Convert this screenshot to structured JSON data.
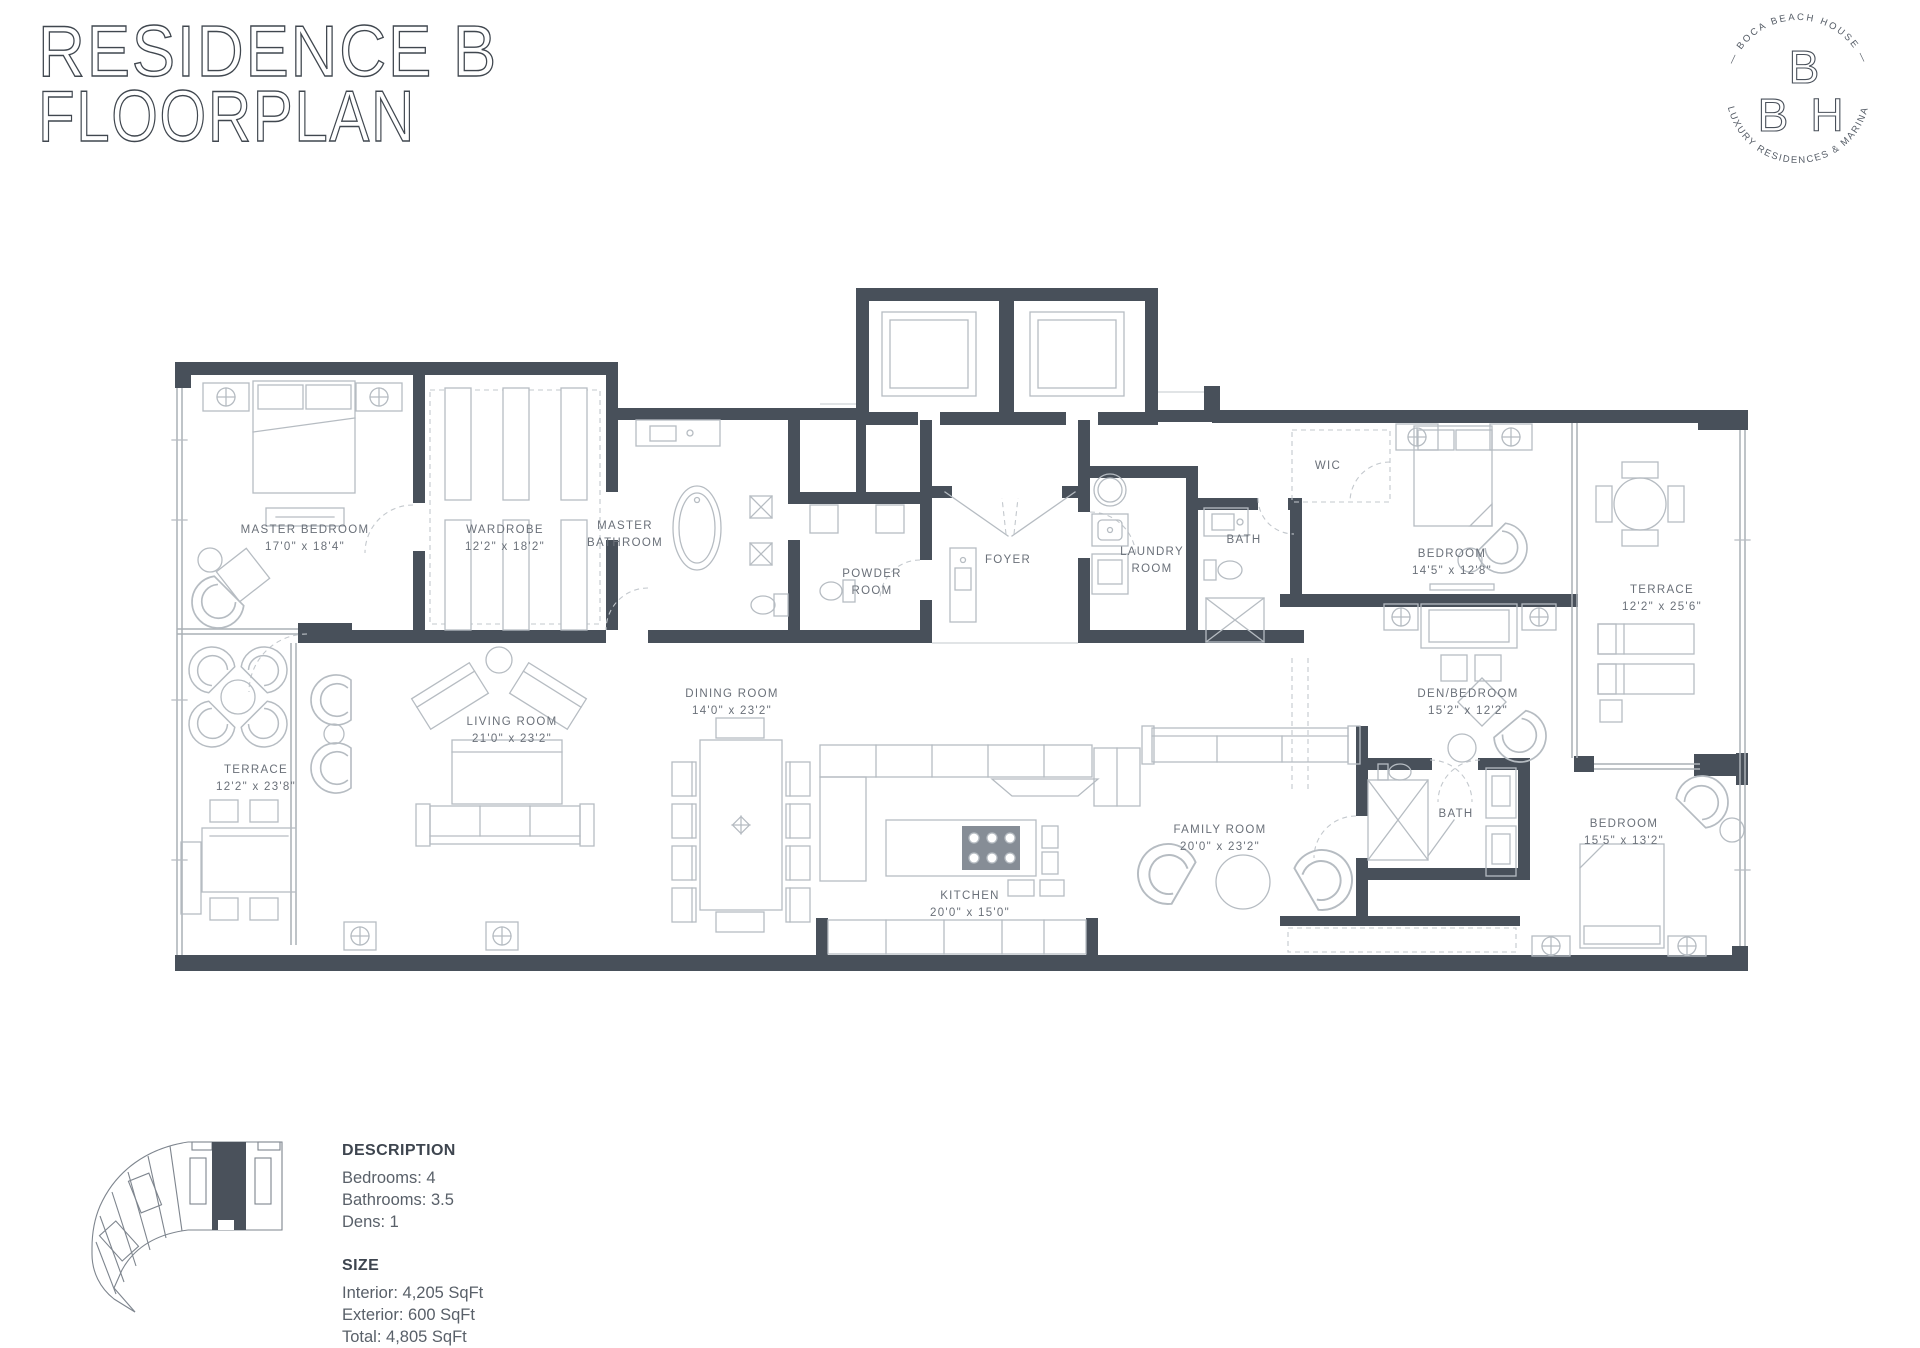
{
  "header": {
    "title_line1": "RESIDENCE B",
    "title_line2": "FLOORPLAN"
  },
  "logo": {
    "arc_top": "— BOCA BEACH HOUSE —",
    "arc_bottom": "LUXURY RESIDENCES & MARINA",
    "monogram_top": "B",
    "monogram_left": "B",
    "monogram_right": "H"
  },
  "rooms": [
    {
      "id": "master-bedroom",
      "line1": "MASTER BEDROOM",
      "line2": "17'0\" x 18'4\""
    },
    {
      "id": "wardrobe",
      "line1": "WARDROBE",
      "line2": "12'2\" x 18'2\""
    },
    {
      "id": "master-bathroom",
      "line1": "MASTER",
      "line2": "BATHROOM"
    },
    {
      "id": "powder-room",
      "line1": "POWDER",
      "line2": "ROOM"
    },
    {
      "id": "foyer",
      "line1": "FOYER",
      "line2": ""
    },
    {
      "id": "laundry-room",
      "line1": "LAUNDRY",
      "line2": "ROOM"
    },
    {
      "id": "bath-center",
      "line1": "BATH",
      "line2": ""
    },
    {
      "id": "wic",
      "line1": "WIC",
      "line2": ""
    },
    {
      "id": "bedroom-upper",
      "line1": "BEDROOM",
      "line2": "14'5\" x 12'8\""
    },
    {
      "id": "terrace-right",
      "line1": "TERRACE",
      "line2": "12'2\" x 25'6\""
    },
    {
      "id": "den-bedroom",
      "line1": "DEN/BEDROOM",
      "line2": "15'2\" x 12'2\""
    },
    {
      "id": "living-room",
      "line1": "LIVING ROOM",
      "line2": "21'0\" x 23'2\""
    },
    {
      "id": "dining-room",
      "line1": "DINING ROOM",
      "line2": "14'0\" x 23'2\""
    },
    {
      "id": "terrace-left",
      "line1": "TERRACE",
      "line2": "12'2\" x 23'8\""
    },
    {
      "id": "kitchen",
      "line1": "KITCHEN",
      "line2": "20'0\" x 15'0\""
    },
    {
      "id": "family-room",
      "line1": "FAMILY ROOM",
      "line2": "20'0\" x 23'2\""
    },
    {
      "id": "bath-lower",
      "line1": "BATH",
      "line2": ""
    },
    {
      "id": "bedroom-lower",
      "line1": "BEDROOM",
      "line2": "15'5\" x 13'2\""
    }
  ],
  "details": {
    "description_title": "DESCRIPTION",
    "description_items": [
      "Bedrooms: 4",
      "Bathrooms: 3.5",
      "Dens: 1"
    ],
    "size_title": "SIZE",
    "size_items": [
      "Interior: 4,205 SqFt",
      "Exterior: 600 SqFt",
      "Total: 4,805 SqFt"
    ]
  },
  "colors": {
    "wall": "#48505a",
    "furniture_line": "#b6bcc2",
    "label_text": "#6a7079",
    "title_outline": "#40474f"
  }
}
